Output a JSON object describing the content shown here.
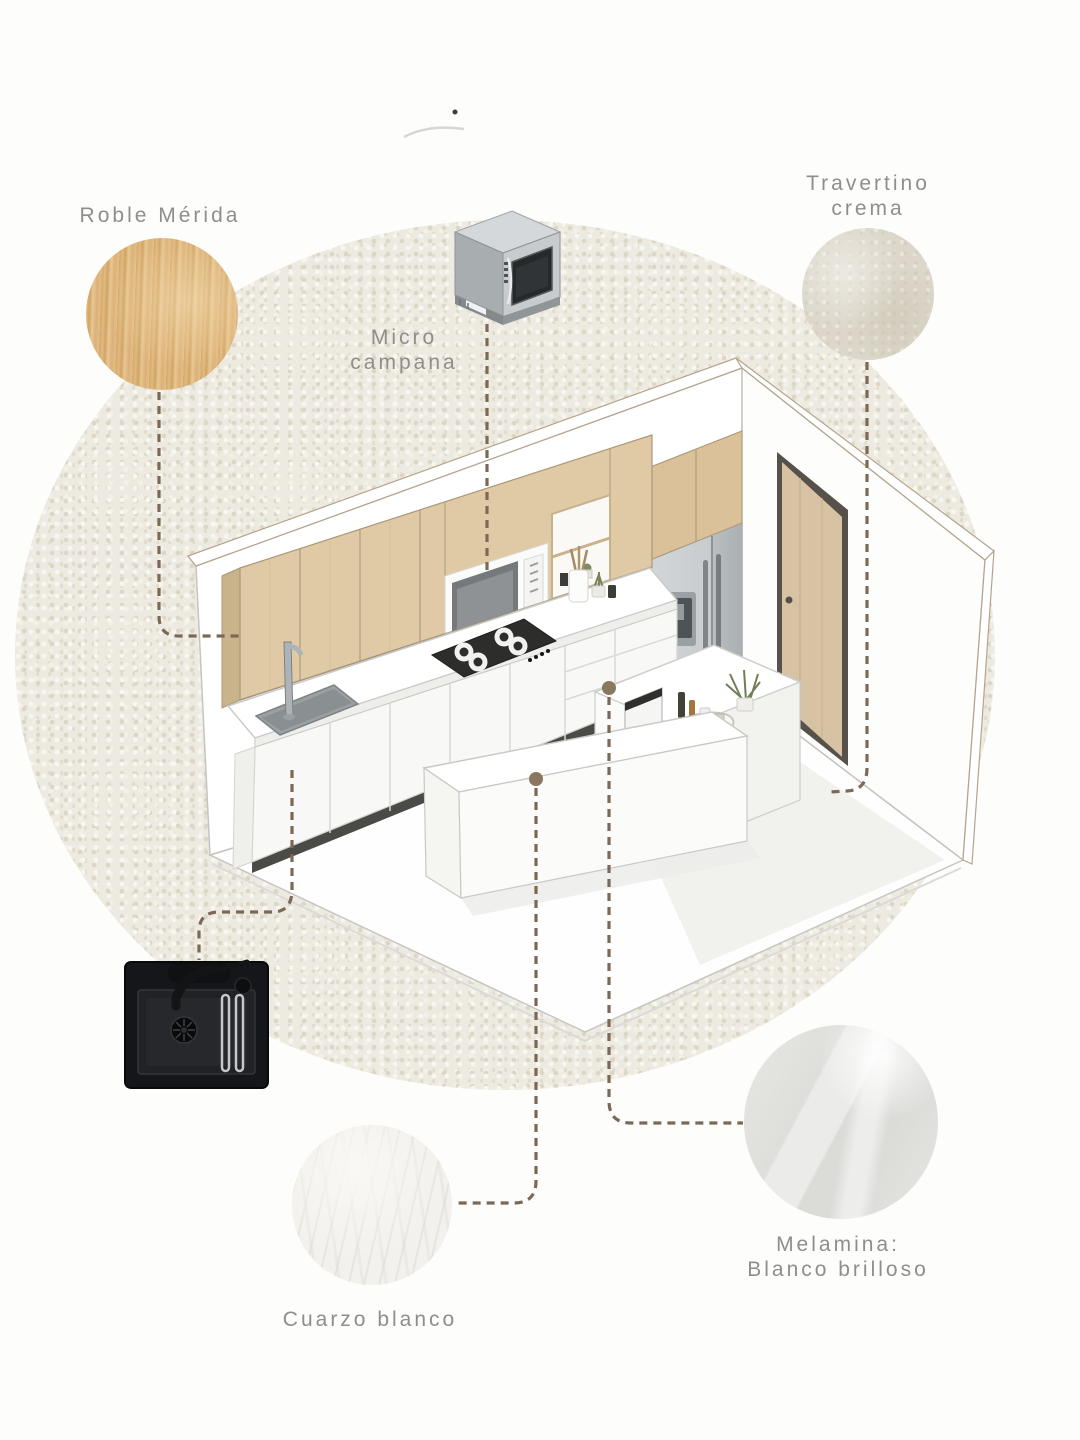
{
  "board": {
    "title_hint": "kitchen materials moodboard",
    "labels": {
      "roble": "Roble Mérida",
      "micro1": "Micro",
      "micro2": "campana",
      "trav1": "Travertino",
      "trav2": "crema",
      "cuarzo": "Cuarzo blanco",
      "mel1": "Melamina:",
      "mel2": "Blanco brilloso"
    }
  },
  "colors": {
    "page_background": "#fdfdfb",
    "texture_circle": "#edeae1",
    "label_text": "#908e8a",
    "dashed_connector": "#7c6955",
    "connector_dot": "#8a7760",
    "wood_swatch": "#ddb87e",
    "travertine_swatch": "#dcd7ca",
    "quartz_swatch": "#f2f1ed",
    "melamine_swatch": "#e2e2df",
    "cabinet_wood": "#dfc9a5",
    "cooktop_black": "#2d2d2b",
    "sink_black": "#151619",
    "fridge_steel": "#c6cacc"
  }
}
